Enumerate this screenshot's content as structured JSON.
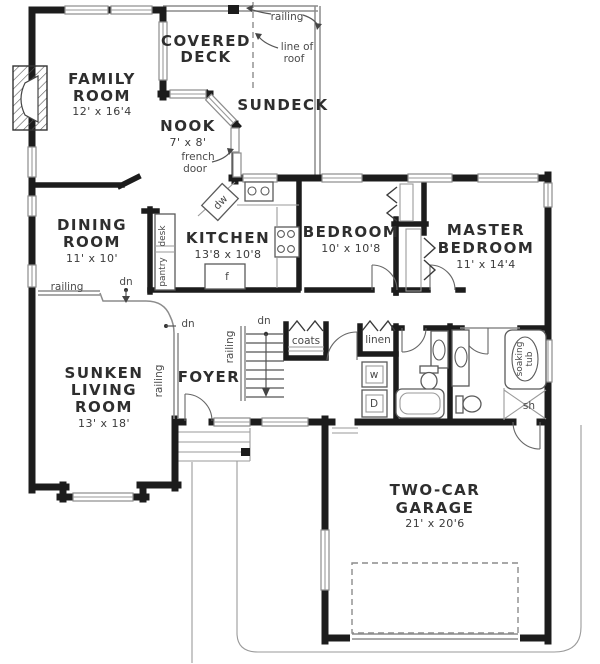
{
  "page": {
    "title": "House Floor Plan"
  },
  "rooms": {
    "family_room": {
      "line1": "FAMILY",
      "line2": "ROOM",
      "dims": "12' x 16'4"
    },
    "covered_deck": {
      "line1": "COVERED",
      "line2": "DECK"
    },
    "sundeck": {
      "name": "SUNDECK"
    },
    "nook": {
      "name": "NOOK",
      "dims": "7' x 8'"
    },
    "dining_room": {
      "line1": "DINING",
      "line2": "ROOM",
      "dims": "11' x 10'"
    },
    "kitchen": {
      "name": "KITCHEN",
      "dims": "13'8 x 10'8"
    },
    "bedroom": {
      "name": "BEDROOM",
      "dims": "10' x 10'8"
    },
    "master_bedroom": {
      "line1": "MASTER",
      "line2": "BEDROOM",
      "dims": "11' x 14'4"
    },
    "sunken_living_room": {
      "line1": "SUNKEN",
      "line2": "LIVING",
      "line3": "ROOM",
      "dims": "13' x 18'"
    },
    "foyer": {
      "name": "FOYER"
    },
    "garage": {
      "line1": "TWO-CAR",
      "line2": "GARAGE",
      "dims": "21' x 20'6"
    }
  },
  "annotations": {
    "railing": "railing",
    "line_of_roof_line1": "line of",
    "line_of_roof_line2": "roof",
    "french_door_line1": "french",
    "french_door_line2": "door",
    "dn": "dn",
    "coats": "coats",
    "linen": "linen",
    "pantry": "pantry",
    "desk": "desk",
    "washer": "w",
    "dryer": "D",
    "dishwasher": "dw",
    "fridge": "f",
    "soaking_tub_line1": "soaking",
    "soaking_tub_line2": "tub",
    "shower": "sh"
  },
  "colors": {
    "wall": "#1c1c1c",
    "thin_line": "#8c8c8c",
    "room_label": "#2e2e2e",
    "annotation": "#4a4a4a",
    "background": "#ffffff"
  }
}
